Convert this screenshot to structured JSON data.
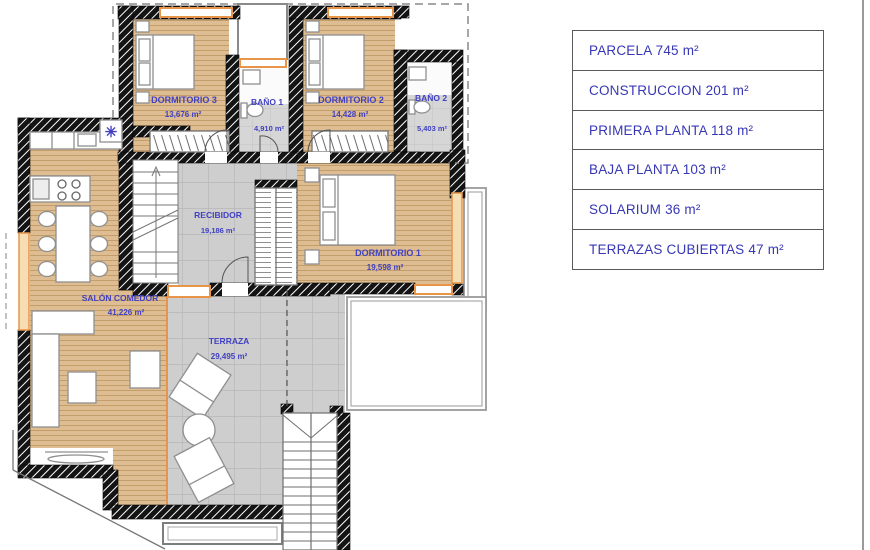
{
  "legend": {
    "items": [
      {
        "text": "PARCELA 745 m²"
      },
      {
        "text": "CONSTRUCCION 201 m²"
      },
      {
        "text": "PRIMERA PLANTA 118 m²"
      },
      {
        "text": "BAJA PLANTA 103 m²"
      },
      {
        "text": "SOLARIUM 36 m²"
      },
      {
        "text": "TERRAZAS CUBIERTAS 47 m²"
      }
    ]
  },
  "rooms": {
    "dormitorio3": {
      "name": "DORMITORIO 3",
      "area": "13,676 m²"
    },
    "bano1": {
      "name": "BAÑO 1",
      "area": "4,910 m²"
    },
    "dormitorio2": {
      "name": "DORMITORIO 2",
      "area": "14,428 m²"
    },
    "bano2": {
      "name": "BAÑO 2",
      "area": "5,403 m²"
    },
    "recibidor": {
      "name": "RECIBIDOR",
      "area": "19,186 m²"
    },
    "dormitorio1": {
      "name": "DORMITORIO 1",
      "area": "19,598 m²"
    },
    "salon": {
      "name": "SALÓN COMEDOR",
      "area": "41,226 m²"
    },
    "terraza": {
      "name": "TERRAZA",
      "area": "29,495 m²"
    }
  },
  "icons": {
    "extractor_fan": "✳"
  },
  "colors": {
    "room_label_blue": "#4141c2",
    "legend_blue": "#3737b5",
    "wood_floor": "#debd92",
    "tile_floor": "#cecece",
    "wall_black": "#141414",
    "window_orange": "#e8954a"
  }
}
